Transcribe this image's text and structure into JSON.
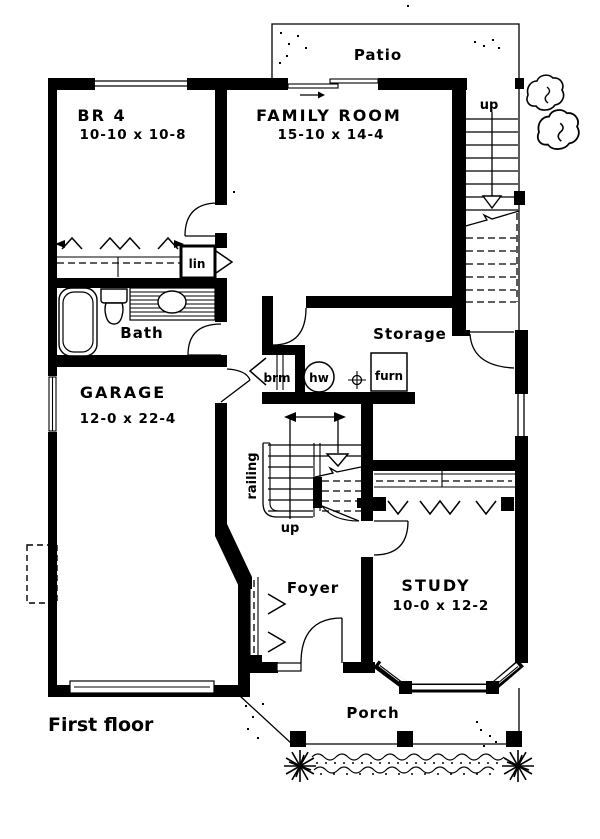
{
  "drawing": {
    "title": "First floor",
    "ink": "#000000",
    "paper": "#ffffff"
  },
  "rooms": {
    "br4": {
      "name": "BR 4",
      "dims": "10-10 x 10-8"
    },
    "family": {
      "name": "FAMILY ROOM",
      "dims": "15-10 x 14-4"
    },
    "garage": {
      "name": "GARAGE",
      "dims": "12-0 x 22-4"
    },
    "study": {
      "name": "STUDY",
      "dims": "10-0 x 12-2"
    },
    "bath": {
      "name": "Bath"
    },
    "storage": {
      "name": "Storage"
    },
    "foyer": {
      "name": "Foyer"
    },
    "patio": {
      "name": "Patio"
    },
    "porch": {
      "name": "Porch"
    }
  },
  "annotations": {
    "linen_closet": "lin",
    "broom_closet": "brm",
    "water_heater": "hw",
    "furnace": "furn",
    "railing": "railing",
    "stair_up_main": "up",
    "stair_up_rear": "up"
  }
}
